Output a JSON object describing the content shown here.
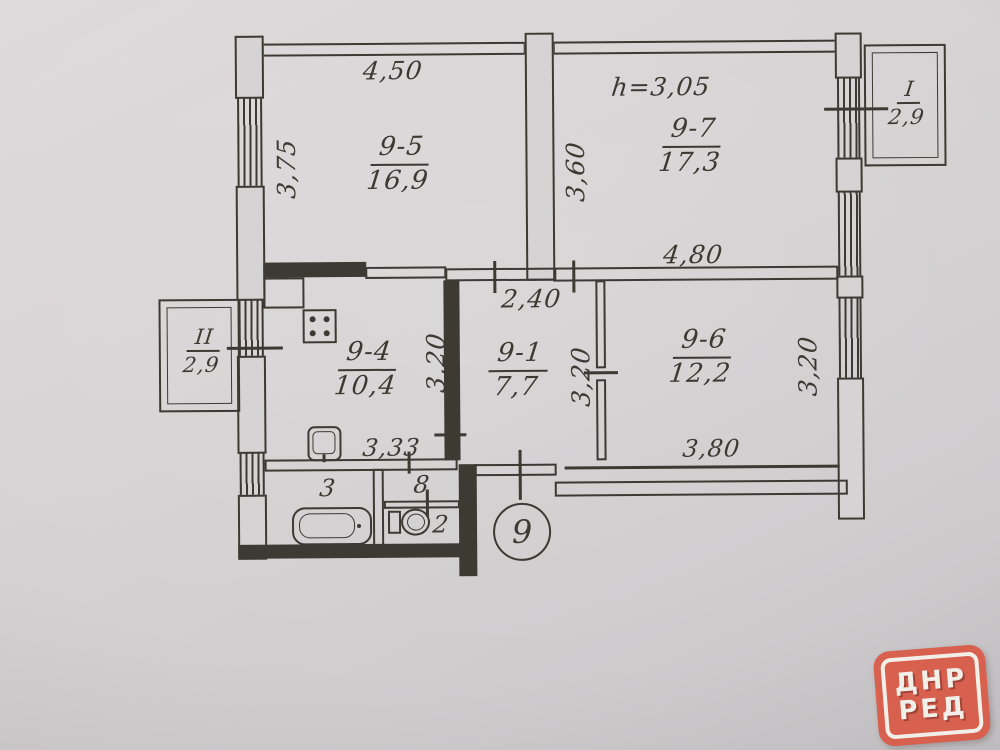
{
  "plan": {
    "apartment_number": "9",
    "ceiling_height": "h=3,05",
    "rooms": {
      "r95": {
        "number": "9-5",
        "area": "16,9"
      },
      "r97": {
        "number": "9-7",
        "area": "17,3"
      },
      "r94": {
        "number": "9-4",
        "area": "10,4"
      },
      "r91": {
        "number": "9-1",
        "area": "7,7"
      },
      "r96": {
        "number": "9-6",
        "area": "12,2"
      },
      "bathroom_number": "3",
      "hall_number": "8",
      "wc_number": "2"
    },
    "balconies": {
      "b1": {
        "number": "I",
        "area": "2,9"
      },
      "b2": {
        "number": "II",
        "area": "2,9"
      }
    },
    "dimensions": {
      "w_95": "4,50",
      "h_95": "3,75",
      "h_97": "3,60",
      "w_97": "4,80",
      "w_91": "2,40",
      "h_91": "3,20",
      "h_94": "3,20",
      "w_94": "3,33",
      "h_96": "3,20",
      "w_96": "3,80"
    }
  },
  "logo": {
    "line1": "ДНР",
    "line2": "РЕД"
  }
}
